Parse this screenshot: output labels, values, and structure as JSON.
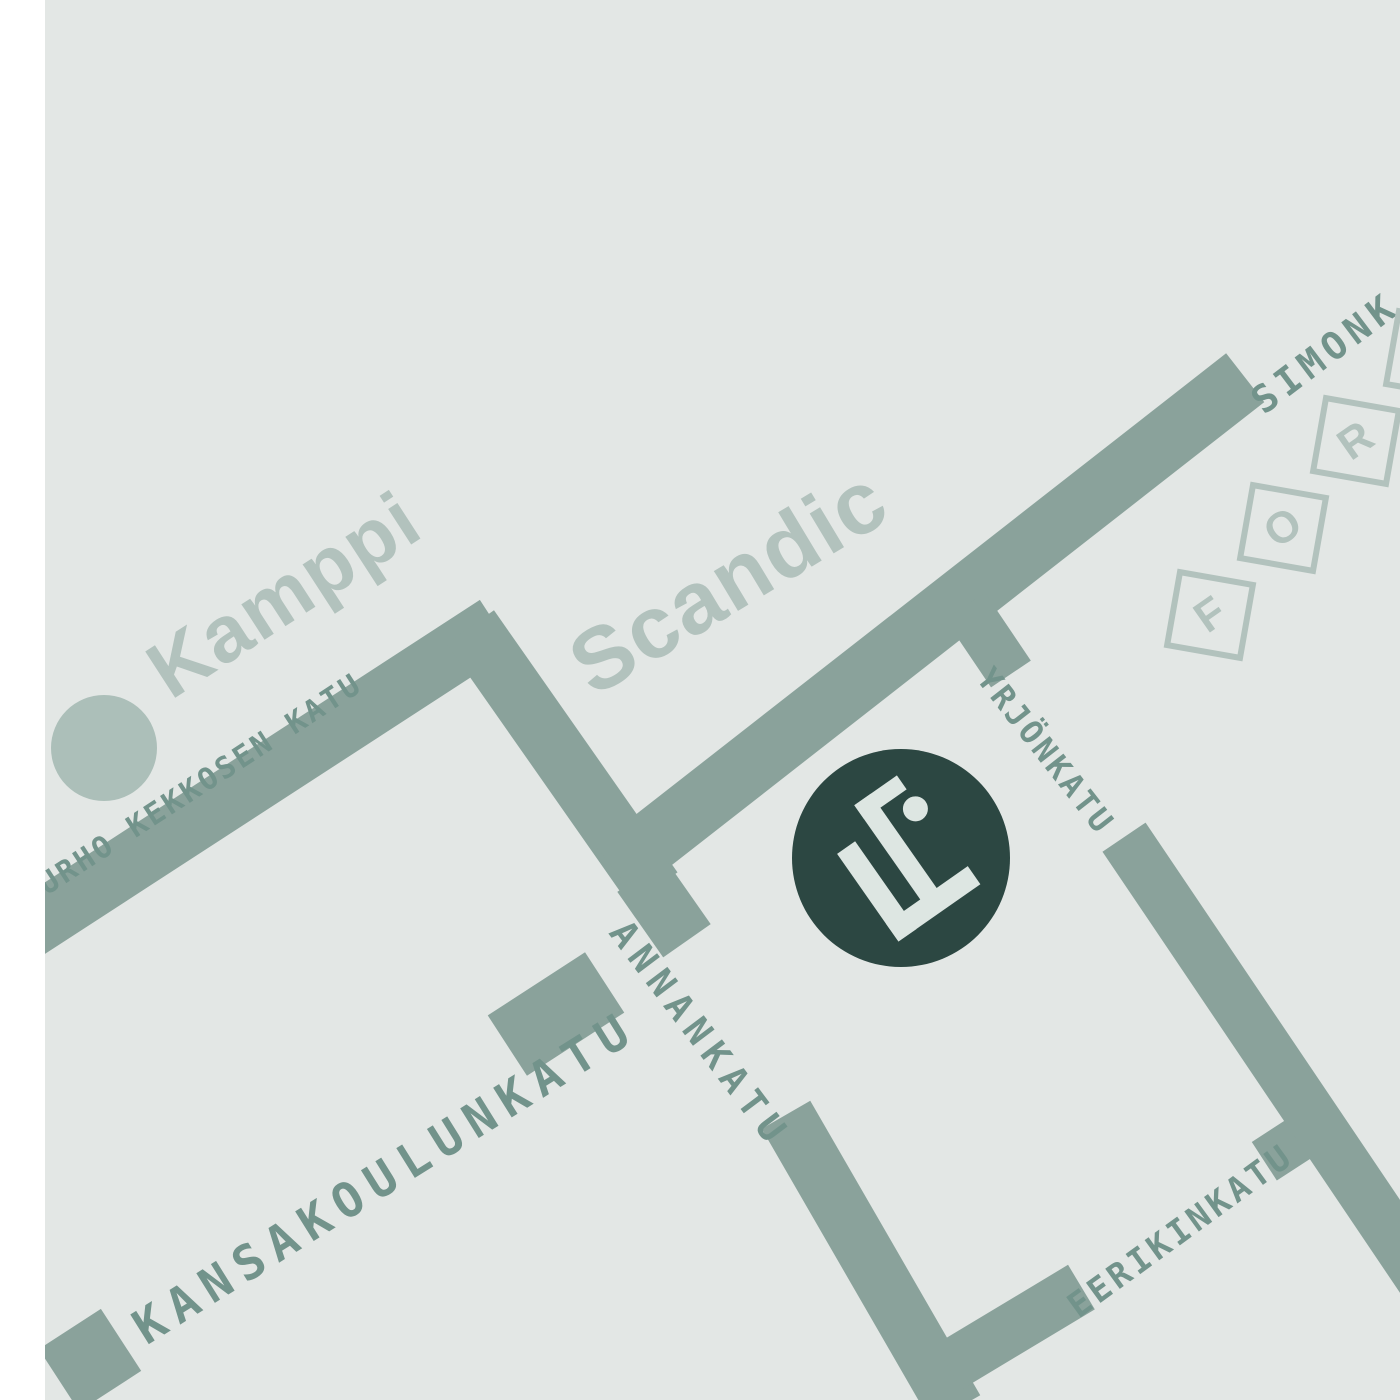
{
  "colors": {
    "background": "#e3e7e5",
    "margin": "#ffffff",
    "road": "#8aa29b",
    "street_label": "#72938b",
    "landmark_label": "#b2c2bd",
    "station_dot": "#acbfb9",
    "logo_circle": "#2c4742",
    "logo_mark": "#dde6e2"
  },
  "streets": {
    "simonkatu": {
      "label": "SIMONK"
    },
    "urho_kekkosen_katu": {
      "label": "URHO KEKKOSEN KATU"
    },
    "kansakoulunkatu": {
      "label": "KANSAKOULUNKATU"
    },
    "annankatu": {
      "label": "ANNANKATU"
    },
    "yrjonkatu": {
      "label": "YRJÖNKATU"
    },
    "eerikinkatu": {
      "label": "EERIKINKATU"
    }
  },
  "landmarks": {
    "kamppi": {
      "label": "Kamppi"
    },
    "scandic": {
      "label": "Scandic"
    },
    "forum": {
      "letters": [
        "F",
        "O",
        "R",
        ""
      ]
    }
  },
  "logo": {
    "monogram": "LF"
  }
}
